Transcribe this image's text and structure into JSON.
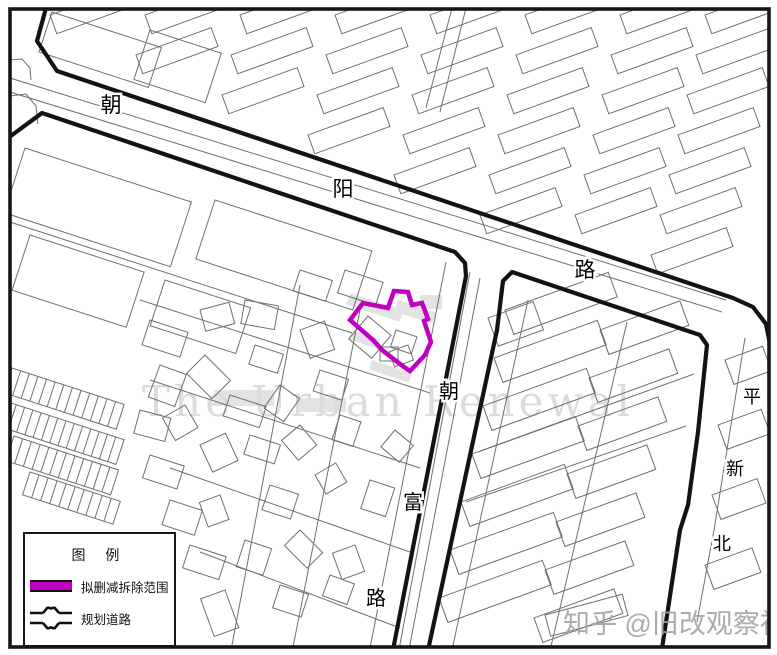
{
  "legend": {
    "title": "图 例",
    "items": [
      {
        "label": "拟删减拆除范围",
        "type": "demolition-boundary-swatch"
      },
      {
        "label": "规划道路",
        "type": "planned-road-swatch"
      }
    ]
  },
  "watermarks": {
    "center": {
      "text": "The Urban Renewal",
      "x": 388,
      "y": 416,
      "size": 42,
      "color": "#dcdcdc",
      "spacing": 4
    },
    "corner": {
      "text": "知乎 @旧改观察社",
      "x": 563,
      "y": 633,
      "size": 27,
      "color": "#a3a3a3"
    }
  },
  "map": {
    "colors": {
      "thin": "#6f6f6f",
      "thick": "#131313",
      "frame": "#161616",
      "demolition": "#c000c0",
      "shade": "#e3e3e3"
    },
    "labels": [
      {
        "name": "chaoyang-road",
        "font": 21,
        "chars": [
          {
            "c": "朝",
            "x": 111,
            "y": 112
          },
          {
            "c": "阳",
            "x": 343,
            "y": 196
          },
          {
            "c": "路",
            "x": 585,
            "y": 277
          }
        ]
      },
      {
        "name": "chaofu-road",
        "font": 20,
        "chars": [
          {
            "c": "朝",
            "x": 449,
            "y": 398
          },
          {
            "c": "富",
            "x": 413,
            "y": 509
          },
          {
            "c": "路",
            "x": 376,
            "y": 605
          }
        ]
      },
      {
        "name": "pingxinbei-road",
        "font": 18,
        "chars": [
          {
            "c": "平",
            "x": 752,
            "y": 403
          },
          {
            "c": "新",
            "x": 735,
            "y": 475
          },
          {
            "c": "北",
            "x": 722,
            "y": 550
          }
        ]
      }
    ],
    "demolition_polygon": [
      [
        350,
        320
      ],
      [
        363,
        303
      ],
      [
        388,
        308
      ],
      [
        394,
        291
      ],
      [
        408,
        292
      ],
      [
        412,
        305
      ],
      [
        422,
        303
      ],
      [
        428,
        319
      ],
      [
        424,
        321
      ],
      [
        431,
        342
      ],
      [
        425,
        355
      ],
      [
        410,
        371
      ],
      [
        404,
        367
      ],
      [
        382,
        350
      ],
      [
        373,
        340
      ]
    ],
    "thick_roads": [
      [
        [
          46,
          8
        ],
        [
          37,
          41
        ],
        [
          57,
          71
        ],
        [
          733,
          298
        ],
        [
          753,
          307
        ],
        [
          766,
          324
        ],
        [
          770,
          344
        ]
      ],
      [
        [
          8,
          138
        ],
        [
          42,
          113
        ],
        [
          455,
          252
        ],
        [
          465,
          263
        ],
        [
          466,
          276
        ],
        [
          392,
          655
        ]
      ],
      [
        [
          427,
          655
        ],
        [
          497,
          330
        ],
        [
          503,
          281
        ],
        [
          512,
          272
        ],
        [
          700,
          335
        ],
        [
          707,
          345
        ],
        [
          698,
          432
        ],
        [
          688,
          505
        ],
        [
          680,
          530
        ],
        [
          661,
          655
        ]
      ]
    ],
    "thin_lines": [
      [
        [
          10,
          78
        ],
        [
          726,
          300
        ]
      ],
      [
        [
          10,
          92
        ],
        [
          722,
          312
        ]
      ],
      [
        [
          10,
          222
        ],
        [
          352,
          333
        ]
      ],
      [
        [
          470,
          272
        ],
        [
          398,
          655
        ]
      ],
      [
        [
          480,
          278
        ],
        [
          408,
          655
        ]
      ],
      [
        [
          446,
          262
        ],
        [
          370,
          648
        ]
      ],
      [
        [
          745,
          338
        ],
        [
          714,
          530
        ],
        [
          697,
          622
        ]
      ],
      [
        [
          452,
          8
        ],
        [
          426,
          108
        ]
      ],
      [
        [
          466,
          8
        ],
        [
          440,
          112
        ]
      ],
      [
        [
          10,
          96
        ],
        [
          26,
          94
        ],
        [
          36,
          106
        ],
        [
          38,
          124
        ]
      ],
      [
        [
          10,
          60
        ],
        [
          22,
          59
        ],
        [
          30,
          68
        ],
        [
          31,
          80
        ]
      ],
      [
        [
          140,
          300
        ],
        [
          430,
          393
        ]
      ],
      [
        [
          150,
          380
        ],
        [
          420,
          468
        ]
      ],
      [
        [
          170,
          468
        ],
        [
          410,
          552
        ]
      ],
      [
        [
          200,
          552
        ],
        [
          400,
          628
        ]
      ],
      [
        [
          300,
          285
        ],
        [
          232,
          645
        ]
      ],
      [
        [
          362,
          300
        ],
        [
          292,
          652
        ]
      ],
      [
        [
          528,
          300
        ],
        [
          452,
          650
        ]
      ],
      [
        [
          627,
          322
        ],
        [
          549,
          655
        ]
      ],
      [
        [
          478,
          452
        ],
        [
          694,
          374
        ]
      ],
      [
        [
          466,
          502
        ],
        [
          686,
          426
        ]
      ]
    ],
    "shading": [
      [
        350,
        293,
        56,
        12,
        18
      ],
      [
        398,
        300,
        40,
        12,
        18
      ],
      [
        420,
        295,
        22,
        14,
        0
      ],
      [
        352,
        330,
        30,
        10,
        18
      ],
      [
        372,
        360,
        42,
        10,
        18
      ],
      [
        214,
        390,
        60,
        16,
        0
      ],
      [
        300,
        398,
        46,
        14,
        0
      ]
    ],
    "hatch_rows": [
      [
        12,
        368,
        118,
        26,
        18,
        13
      ],
      [
        8,
        402,
        122,
        26,
        18,
        14
      ],
      [
        14,
        436,
        110,
        26,
        18,
        12
      ],
      [
        30,
        472,
        95,
        24,
        18,
        10
      ]
    ],
    "big_blocks": [
      [
        52,
        12,
        115,
        42,
        18
      ],
      [
        150,
        30,
        75,
        52,
        18
      ],
      [
        25,
        148,
        175,
        68,
        18
      ],
      [
        215,
        200,
        165,
        62,
        18
      ],
      [
        30,
        235,
        120,
        58,
        18
      ],
      [
        165,
        280,
        90,
        48,
        18
      ],
      [
        488,
        318,
        48,
        30,
        -20
      ],
      [
        545,
        615,
        80,
        22,
        -15
      ]
    ],
    "top_slabs_wh": [
      80,
      20,
      -20
    ],
    "top_slabs": [
      [
        50,
        15
      ],
      [
        145,
        15
      ],
      [
        136,
        55
      ],
      [
        240,
        15
      ],
      [
        231,
        55
      ],
      [
        222,
        95
      ],
      [
        335,
        15
      ],
      [
        326,
        55
      ],
      [
        317,
        95
      ],
      [
        308,
        135
      ],
      [
        430,
        15
      ],
      [
        421,
        55
      ],
      [
        412,
        95
      ],
      [
        403,
        135
      ],
      [
        394,
        175
      ],
      [
        525,
        15
      ],
      [
        516,
        55
      ],
      [
        507,
        95
      ],
      [
        498,
        135
      ],
      [
        489,
        175
      ],
      [
        480,
        215
      ],
      [
        620,
        15
      ],
      [
        611,
        55
      ],
      [
        602,
        95
      ],
      [
        593,
        135
      ],
      [
        584,
        175
      ],
      [
        575,
        215
      ],
      [
        705,
        15
      ],
      [
        696,
        55
      ],
      [
        687,
        95
      ],
      [
        678,
        135
      ],
      [
        669,
        175
      ],
      [
        660,
        215
      ],
      [
        651,
        255
      ]
    ],
    "east_slabs_hr": [
      26,
      -20
    ],
    "east_slabs": [
      [
        505,
        310,
        110
      ],
      [
        494,
        358,
        110
      ],
      [
        483,
        406,
        110
      ],
      [
        472,
        454,
        110
      ],
      [
        461,
        502,
        110
      ],
      [
        450,
        550,
        110
      ],
      [
        439,
        598,
        110
      ],
      [
        600,
        330,
        85
      ],
      [
        589,
        378,
        85
      ],
      [
        578,
        426,
        85
      ],
      [
        567,
        474,
        85
      ],
      [
        556,
        522,
        85
      ],
      [
        545,
        570,
        85
      ],
      [
        534,
        618,
        85
      ],
      [
        725,
        360,
        40
      ],
      [
        718,
        425,
        46
      ],
      [
        712,
        495,
        48
      ],
      [
        705,
        565,
        50
      ]
    ],
    "village": [
      [
        150,
        320,
        40,
        26,
        18
      ],
      [
        200,
        310,
        30,
        22,
        -15
      ],
      [
        245,
        300,
        34,
        24,
        10
      ],
      [
        160,
        365,
        28,
        34,
        20
      ],
      [
        205,
        355,
        36,
        26,
        45
      ],
      [
        255,
        345,
        30,
        20,
        18
      ],
      [
        300,
        330,
        26,
        30,
        -20
      ],
      [
        140,
        410,
        32,
        24,
        15
      ],
      [
        185,
        405,
        26,
        26,
        60
      ],
      [
        230,
        395,
        38,
        22,
        18
      ],
      [
        280,
        385,
        24,
        28,
        35
      ],
      [
        320,
        370,
        30,
        22,
        18
      ],
      [
        150,
        455,
        36,
        24,
        18
      ],
      [
        200,
        445,
        28,
        30,
        -25
      ],
      [
        250,
        435,
        32,
        20,
        18
      ],
      [
        300,
        425,
        26,
        24,
        50
      ],
      [
        340,
        415,
        22,
        26,
        18
      ],
      [
        170,
        500,
        34,
        26,
        18
      ],
      [
        220,
        495,
        26,
        22,
        70
      ],
      [
        270,
        485,
        30,
        26,
        18
      ],
      [
        315,
        475,
        24,
        22,
        -30
      ],
      [
        190,
        545,
        38,
        24,
        18
      ],
      [
        245,
        540,
        28,
        28,
        18
      ],
      [
        300,
        530,
        32,
        22,
        45
      ],
      [
        225,
        590,
        40,
        26,
        70
      ],
      [
        280,
        585,
        30,
        24,
        18
      ],
      [
        330,
        575,
        26,
        22,
        20
      ],
      [
        355,
        545,
        28,
        24,
        70
      ],
      [
        370,
        480,
        26,
        30,
        18
      ],
      [
        395,
        430,
        24,
        22,
        40
      ],
      [
        368,
        316,
        30,
        30,
        40
      ],
      [
        396,
        330,
        22,
        18,
        18
      ],
      [
        408,
        345,
        16,
        20,
        70
      ],
      [
        380,
        347,
        18,
        14,
        0
      ],
      [
        345,
        270,
        40,
        24,
        18
      ],
      [
        300,
        270,
        34,
        22,
        18
      ]
    ]
  }
}
